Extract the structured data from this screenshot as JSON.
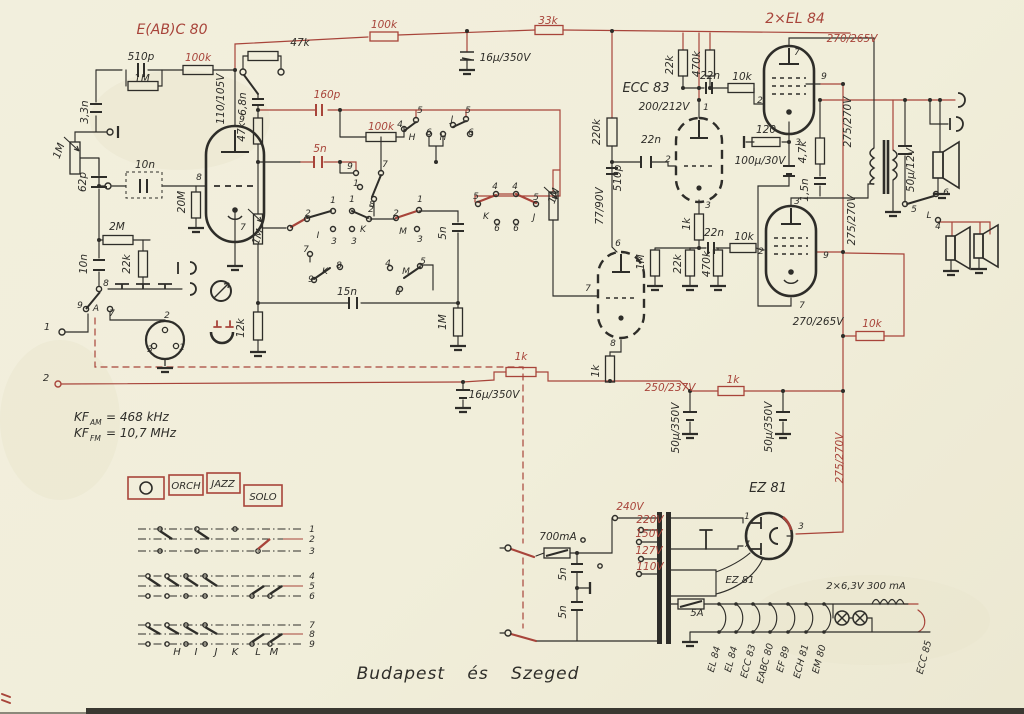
{
  "caption": "Budapest és Szeged",
  "colors": {
    "ink": "#2e2d29",
    "red": "#a8443a",
    "paper": "#f1eeda"
  },
  "panel": {
    "buttons": [
      {
        "label": "",
        "icon": "record-dot"
      },
      {
        "label": "ORCH"
      },
      {
        "label": "JAZZ"
      },
      {
        "label": "SOLO"
      }
    ]
  },
  "matrix": {
    "rows": [
      "1",
      "2",
      "3",
      "4",
      "5",
      "6",
      "7",
      "8",
      "9"
    ],
    "columns": [
      "H",
      "I",
      "J",
      "K",
      "L",
      "M"
    ]
  },
  "labels": [
    {
      "t": "E(AB)C 80",
      "x": 172,
      "y": 34,
      "c": "r",
      "s": 14
    },
    {
      "t": "510p",
      "x": 141,
      "y": 60
    },
    {
      "t": "100k",
      "x": 198,
      "y": 61,
      "c": "r"
    },
    {
      "t": "1M",
      "x": 142,
      "y": 82
    },
    {
      "t": "3,3n",
      "x": 88,
      "y": 112,
      "r": -90
    },
    {
      "t": "110/105V",
      "x": 224,
      "y": 99,
      "r": -90
    },
    {
      "t": "9",
      "x": 242,
      "y": 122,
      "s": 9
    },
    {
      "t": "8",
      "x": 199,
      "y": 180,
      "s": 9
    },
    {
      "t": "7",
      "x": 243,
      "y": 230,
      "s": 9
    },
    {
      "t": "47k",
      "x": 300,
      "y": 46
    },
    {
      "t": "6,8n",
      "x": 246,
      "y": 104,
      "r": -90
    },
    {
      "t": "160p",
      "x": 327,
      "y": 98,
      "c": "r"
    },
    {
      "t": "47k",
      "x": 245,
      "y": 132,
      "r": -90
    },
    {
      "t": "5n",
      "x": 320,
      "y": 152,
      "c": "r"
    },
    {
      "t": "1M",
      "x": 62,
      "y": 152,
      "r": -70
    },
    {
      "t": "62p",
      "x": 86,
      "y": 182,
      "r": -90
    },
    {
      "t": "10n",
      "x": 145,
      "y": 168
    },
    {
      "t": "20M",
      "x": 185,
      "y": 202,
      "r": -90
    },
    {
      "t": "2M",
      "x": 117,
      "y": 230
    },
    {
      "t": "22k",
      "x": 130,
      "y": 264,
      "r": -90
    },
    {
      "t": "10n",
      "x": 87,
      "y": 264,
      "r": -90
    },
    {
      "t": "8",
      "x": 106,
      "y": 286,
      "s": 9
    },
    {
      "t": "9",
      "x": 80,
      "y": 308,
      "s": 9
    },
    {
      "t": "A",
      "x": 96,
      "y": 311,
      "s": 9
    },
    {
      "t": "7",
      "x": 112,
      "y": 316,
      "s": 9
    },
    {
      "t": "1",
      "x": 47,
      "y": 330,
      "s": 10
    },
    {
      "t": "2",
      "x": 46,
      "y": 381,
      "s": 10
    },
    {
      "t": "2",
      "x": 167,
      "y": 318,
      "s": 9
    },
    {
      "t": "3",
      "x": 150,
      "y": 352,
      "s": 9
    },
    {
      "t": "1",
      "x": 182,
      "y": 350,
      "s": 9
    },
    {
      "t": "12k",
      "x": 244,
      "y": 328,
      "r": -90
    },
    {
      "t": "100k",
      "x": 384,
      "y": 28,
      "c": "r"
    },
    {
      "t": "33k",
      "x": 548,
      "y": 24,
      "c": "r"
    },
    {
      "t": "16μ/350V",
      "x": 505,
      "y": 61
    },
    {
      "t": "16μ/350V",
      "x": 494,
      "y": 398
    },
    {
      "t": "9",
      "x": 350,
      "y": 169,
      "s": 9
    },
    {
      "t": "7",
      "x": 385,
      "y": 167,
      "s": 9
    },
    {
      "t": "1",
      "x": 356,
      "y": 186,
      "s": 9
    },
    {
      "t": "8",
      "x": 372,
      "y": 207,
      "s": 9
    },
    {
      "t": "100k",
      "x": 381,
      "y": 130,
      "c": "r"
    },
    {
      "t": "5",
      "x": 420,
      "y": 113,
      "s": 9
    },
    {
      "t": "4",
      "x": 400,
      "y": 127,
      "s": 9
    },
    {
      "t": "H",
      "x": 412,
      "y": 140,
      "s": 9
    },
    {
      "t": "6",
      "x": 429,
      "y": 135,
      "s": 9
    },
    {
      "t": "H",
      "x": 443,
      "y": 140,
      "s": 9
    },
    {
      "t": "J",
      "x": 452,
      "y": 122,
      "s": 9
    },
    {
      "t": "5",
      "x": 468,
      "y": 113,
      "s": 9
    },
    {
      "t": "6",
      "x": 471,
      "y": 135,
      "s": 9
    },
    {
      "t": "2",
      "x": 308,
      "y": 216,
      "s": 9
    },
    {
      "t": "1",
      "x": 333,
      "y": 203,
      "s": 9
    },
    {
      "t": "1",
      "x": 352,
      "y": 202,
      "s": 9
    },
    {
      "t": "2",
      "x": 371,
      "y": 212,
      "s": 9
    },
    {
      "t": "2",
      "x": 396,
      "y": 216,
      "s": 9
    },
    {
      "t": "1",
      "x": 420,
      "y": 202,
      "s": 9
    },
    {
      "t": "I",
      "x": 318,
      "y": 238,
      "s": 9
    },
    {
      "t": "3",
      "x": 334,
      "y": 244,
      "s": 9
    },
    {
      "t": "3",
      "x": 354,
      "y": 244,
      "s": 9
    },
    {
      "t": "K",
      "x": 363,
      "y": 232,
      "s": 9
    },
    {
      "t": "M",
      "x": 403,
      "y": 234,
      "s": 9
    },
    {
      "t": "3",
      "x": 420,
      "y": 242,
      "s": 9
    },
    {
      "t": "1M",
      "x": 261,
      "y": 238,
      "r": -70
    },
    {
      "t": "7",
      "x": 306,
      "y": 252,
      "s": 9
    },
    {
      "t": "9",
      "x": 311,
      "y": 282,
      "s": 9
    },
    {
      "t": "K",
      "x": 325,
      "y": 274,
      "s": 9
    },
    {
      "t": "8",
      "x": 339,
      "y": 268,
      "s": 9
    },
    {
      "t": "4",
      "x": 388,
      "y": 266,
      "s": 9
    },
    {
      "t": "M",
      "x": 406,
      "y": 274,
      "s": 9
    },
    {
      "t": "5",
      "x": 423,
      "y": 264,
      "s": 9
    },
    {
      "t": "6",
      "x": 398,
      "y": 295,
      "s": 9
    },
    {
      "t": "15n",
      "x": 347,
      "y": 295
    },
    {
      "t": "5n",
      "x": 446,
      "y": 233,
      "r": -90
    },
    {
      "t": "1M",
      "x": 446,
      "y": 322,
      "r": -90
    },
    {
      "t": "5",
      "x": 476,
      "y": 199,
      "s": 9
    },
    {
      "t": "4",
      "x": 495,
      "y": 189,
      "s": 9
    },
    {
      "t": "4",
      "x": 515,
      "y": 189,
      "s": 9
    },
    {
      "t": "5",
      "x": 536,
      "y": 200,
      "s": 9
    },
    {
      "t": "K",
      "x": 486,
      "y": 219,
      "s": 9
    },
    {
      "t": "6",
      "x": 497,
      "y": 231,
      "s": 9
    },
    {
      "t": "6",
      "x": 516,
      "y": 231,
      "s": 9
    },
    {
      "t": "J",
      "x": 534,
      "y": 220,
      "s": 9
    },
    {
      "t": "1M",
      "x": 557,
      "y": 197,
      "r": -70
    },
    {
      "t": "ECC 83",
      "x": 646,
      "y": 92,
      "s": 13
    },
    {
      "t": "200/212V",
      "x": 664,
      "y": 110
    },
    {
      "t": "220k",
      "x": 600,
      "y": 132,
      "r": -90
    },
    {
      "t": "22n",
      "x": 651,
      "y": 143
    },
    {
      "t": "510p",
      "x": 621,
      "y": 178,
      "r": -90
    },
    {
      "t": "77/90V",
      "x": 603,
      "y": 206,
      "r": -90
    },
    {
      "t": "1M",
      "x": 644,
      "y": 262,
      "r": -90
    },
    {
      "t": "1k",
      "x": 690,
      "y": 224,
      "r": -90
    },
    {
      "t": "22n",
      "x": 714,
      "y": 236
    },
    {
      "t": "10k",
      "x": 744,
      "y": 240
    },
    {
      "t": "22k",
      "x": 681,
      "y": 264,
      "r": -90
    },
    {
      "t": "470k",
      "x": 710,
      "y": 264,
      "r": -90
    },
    {
      "t": "1",
      "x": 706,
      "y": 110,
      "s": 9
    },
    {
      "t": "2",
      "x": 668,
      "y": 162,
      "s": 9
    },
    {
      "t": "3",
      "x": 708,
      "y": 208,
      "s": 9
    },
    {
      "t": "6",
      "x": 618,
      "y": 246,
      "s": 9
    },
    {
      "t": "7",
      "x": 588,
      "y": 291,
      "s": 9
    },
    {
      "t": "8",
      "x": 613,
      "y": 346,
      "s": 9
    },
    {
      "t": "2×EL 84",
      "x": 795,
      "y": 23,
      "c": "r",
      "s": 14
    },
    {
      "t": "270/265V",
      "x": 852,
      "y": 42,
      "c": "r"
    },
    {
      "t": "22k",
      "x": 673,
      "y": 65,
      "r": -90
    },
    {
      "t": "470k",
      "x": 700,
      "y": 64,
      "r": -90
    },
    {
      "t": "22n",
      "x": 710,
      "y": 79
    },
    {
      "t": "10k",
      "x": 742,
      "y": 80
    },
    {
      "t": "7",
      "x": 797,
      "y": 55,
      "s": 9
    },
    {
      "t": "9",
      "x": 824,
      "y": 79,
      "s": 9
    },
    {
      "t": "2",
      "x": 760,
      "y": 103,
      "s": 9
    },
    {
      "t": "3",
      "x": 798,
      "y": 145,
      "s": 9
    },
    {
      "t": "120",
      "x": 766,
      "y": 133
    },
    {
      "t": "100μ/30V",
      "x": 760,
      "y": 164
    },
    {
      "t": "4,7k",
      "x": 806,
      "y": 152,
      "r": -90
    },
    {
      "t": "1,5n",
      "x": 808,
      "y": 190,
      "r": -90
    },
    {
      "t": "275/270V",
      "x": 851,
      "y": 122,
      "r": -90
    },
    {
      "t": "275/270V",
      "x": 855,
      "y": 220,
      "r": -90
    },
    {
      "t": "3",
      "x": 797,
      "y": 204,
      "s": 9
    },
    {
      "t": "2",
      "x": 761,
      "y": 254,
      "s": 9
    },
    {
      "t": "9",
      "x": 826,
      "y": 258,
      "s": 9
    },
    {
      "t": "7",
      "x": 802,
      "y": 308,
      "s": 9
    },
    {
      "t": "270/265V",
      "x": 818,
      "y": 325
    },
    {
      "t": "10k",
      "x": 872,
      "y": 327,
      "c": "r"
    },
    {
      "t": "50μ/12V",
      "x": 914,
      "y": 170,
      "r": -90
    },
    {
      "t": "6",
      "x": 946,
      "y": 195,
      "s": 9
    },
    {
      "t": "5",
      "x": 914,
      "y": 212,
      "s": 9
    },
    {
      "t": "L",
      "x": 929,
      "y": 218,
      "s": 9
    },
    {
      "t": "4",
      "x": 938,
      "y": 229,
      "s": 9
    },
    {
      "t": "1k",
      "x": 521,
      "y": 360,
      "c": "r"
    },
    {
      "t": "1k",
      "x": 599,
      "y": 371,
      "r": -90
    },
    {
      "t": "250/237V",
      "x": 670,
      "y": 391,
      "c": "r"
    },
    {
      "t": "1k",
      "x": 733,
      "y": 383,
      "c": "r"
    },
    {
      "t": "50μ/350V",
      "x": 679,
      "y": 428,
      "r": -90
    },
    {
      "t": "50μ/350V",
      "x": 772,
      "y": 427,
      "r": -90
    },
    {
      "t": "275/270V",
      "x": 843,
      "y": 458,
      "r": -90,
      "c": "r"
    },
    {
      "t": "KF",
      "x": 74,
      "y": 421,
      "s": 12,
      "a": "s"
    },
    {
      "t": "AM",
      "x": 90,
      "y": 425,
      "s": 7.5,
      "a": "s"
    },
    {
      "t": "= 468 kHz",
      "x": 106,
      "y": 421,
      "s": 12,
      "a": "s"
    },
    {
      "t": "KF",
      "x": 74,
      "y": 437,
      "s": 12,
      "a": "s"
    },
    {
      "t": "FM",
      "x": 90,
      "y": 441,
      "s": 7.5,
      "a": "s"
    },
    {
      "t": "= 10,7 MHz",
      "x": 106,
      "y": 437,
      "s": 12,
      "a": "s"
    },
    {
      "t": "EZ 81",
      "x": 768,
      "y": 492,
      "s": 13
    },
    {
      "t": "240V",
      "x": 630,
      "y": 510,
      "c": "r"
    },
    {
      "t": "220V",
      "x": 650,
      "y": 523,
      "c": "r"
    },
    {
      "t": "150V",
      "x": 649,
      "y": 537,
      "c": "r"
    },
    {
      "t": "127V",
      "x": 649,
      "y": 554,
      "c": "r"
    },
    {
      "t": "110V",
      "x": 650,
      "y": 570,
      "c": "r"
    },
    {
      "t": "700mA",
      "x": 558,
      "y": 540
    },
    {
      "t": "5n",
      "x": 566,
      "y": 574,
      "r": -90
    },
    {
      "t": "5n",
      "x": 566,
      "y": 612,
      "r": -90
    },
    {
      "t": "1",
      "x": 747,
      "y": 519,
      "s": 9
    },
    {
      "t": "7",
      "x": 747,
      "y": 547,
      "s": 9
    },
    {
      "t": "3",
      "x": 801,
      "y": 529,
      "s": 9
    },
    {
      "t": "EZ 81",
      "x": 740,
      "y": 583,
      "s": 10
    },
    {
      "t": "5A",
      "x": 697,
      "y": 616,
      "s": 10
    },
    {
      "t": "2×6,3V 300 mA",
      "x": 866,
      "y": 589,
      "s": 10
    },
    {
      "t": "EL 84",
      "x": 717,
      "y": 660,
      "r": -75,
      "s": 9.5
    },
    {
      "t": "EL 84",
      "x": 734,
      "y": 660,
      "r": -75,
      "s": 9.5
    },
    {
      "t": "ECC 83",
      "x": 751,
      "y": 662,
      "r": -75,
      "s": 9.5
    },
    {
      "t": "EABC 80",
      "x": 768,
      "y": 664,
      "r": -75,
      "s": 9.5
    },
    {
      "t": "EF 89",
      "x": 786,
      "y": 660,
      "r": -75,
      "s": 9.5
    },
    {
      "t": "ECH 81",
      "x": 804,
      "y": 662,
      "r": -75,
      "s": 9.5
    },
    {
      "t": "EM 80",
      "x": 822,
      "y": 660,
      "r": -75,
      "s": 9.5
    },
    {
      "t": "ECC 85",
      "x": 927,
      "y": 658,
      "r": -75,
      "s": 9.5
    }
  ]
}
